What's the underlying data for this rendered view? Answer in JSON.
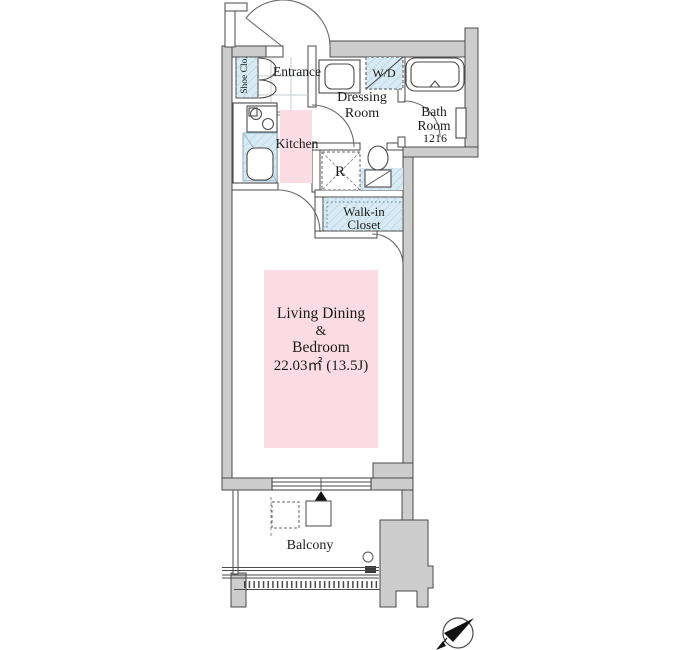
{
  "floorplan": {
    "labels": {
      "entrance": "Entrance",
      "shoe_closet": "Shoe Clo.",
      "dressing_room_line1": "Dressing",
      "dressing_room_line2": "Room",
      "washer_dryer": "W/D",
      "bathroom_line1": "Bath",
      "bathroom_line2": "Room",
      "bathroom_size": "1216",
      "kitchen": "Kitchen",
      "refrigerator": "R",
      "walk_in_closet_line1": "Walk-in",
      "walk_in_closet_line2": "Closet",
      "living_line1": "Living Dining",
      "living_line2": "&",
      "living_line3": "Bedroom",
      "living_area": "22.03㎡ (13.5J)",
      "balcony": "Balcony"
    },
    "colors": {
      "room_pink": "#fbdce5",
      "wet_area_blue": "#d8eaf3",
      "wall_gray": "#cdcdcd",
      "line_dark": "#4a4a4a"
    }
  }
}
